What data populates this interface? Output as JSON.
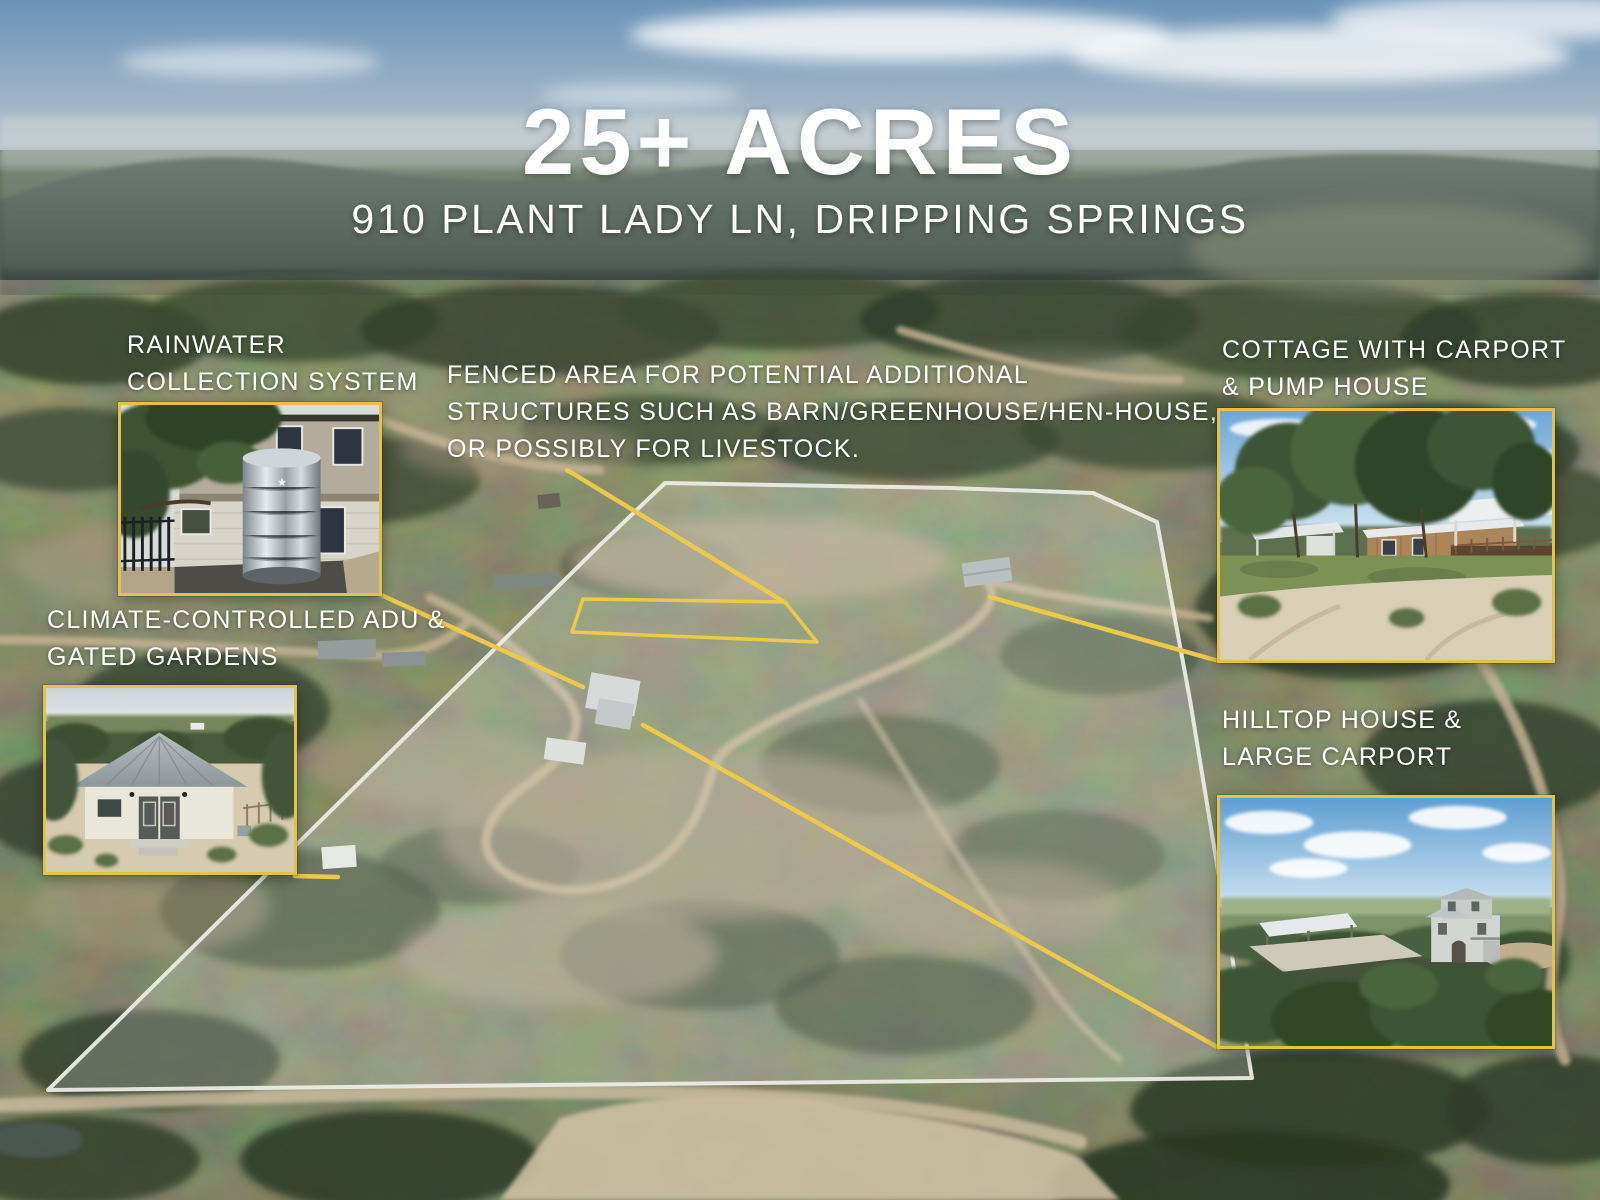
{
  "title": "25+ ACRES",
  "subtitle": "910 PLANT LADY LN, DRIPPING SPRINGS",
  "callouts": {
    "rainwater": {
      "label": "RAINWATER\nCOLLECTION SYSTEM"
    },
    "fenced_area": {
      "label": "FENCED AREA FOR POTENTIAL ADDITIONAL\nSTRUCTURES SUCH AS BARN/GREENHOUSE/HEN-HOUSE,\nOR POSSIBLY FOR LIVESTOCK."
    },
    "cottage": {
      "label": "COTTAGE WITH CARPORT\n& PUMP HOUSE"
    },
    "adu": {
      "label": "CLIMATE-CONTROLLED ADU &\nGATED GARDENS"
    },
    "hilltop": {
      "label": "HILLTOP HOUSE &\nLARGE CARPORT"
    }
  },
  "photos": {
    "rainwater": {
      "alt": "Two-story home with galvanized rainwater collection tank"
    },
    "cottage": {
      "alt": "Cottage with deck, carport and pump house among oak trees"
    },
    "adu": {
      "alt": "Climate-controlled ADU with metal roof and gated gardens"
    },
    "hilltop": {
      "alt": "Aerial view of hilltop house and large carport"
    }
  },
  "colors": {
    "accent_yellow": "#E2C24A",
    "boundary_white": "#EDEDE6",
    "text_white": "#FFFFFF"
  }
}
